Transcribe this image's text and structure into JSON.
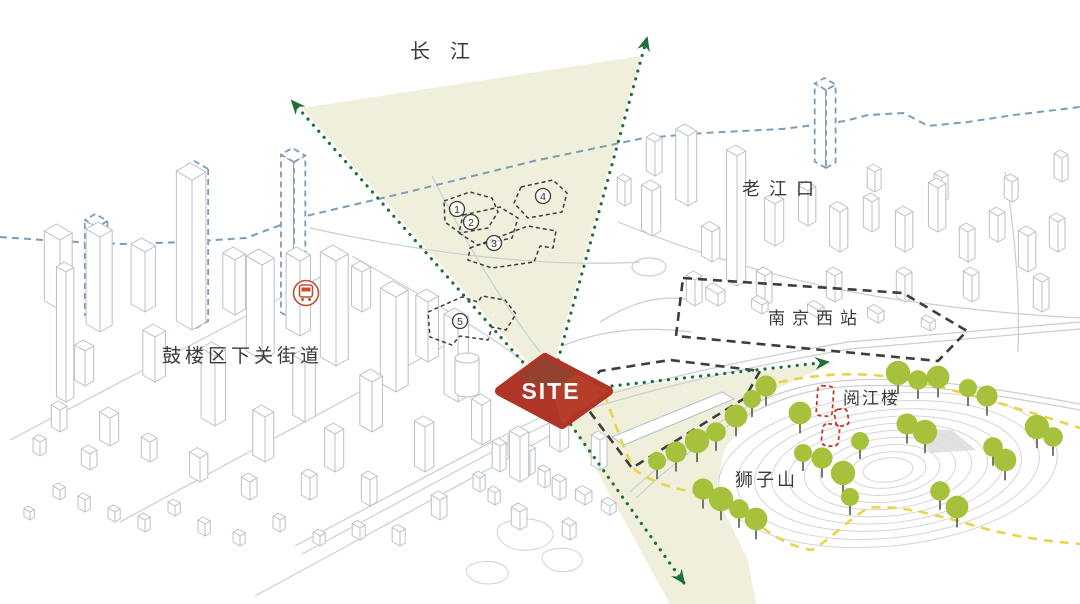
{
  "labels": {
    "yangtze": "长江",
    "laojiangkou": "老江口",
    "gulou_street": "鼓楼区下关街道",
    "nanjing_west_station": "南京西站",
    "yuejiang_tower": "阅江楼",
    "lion_mountain": "狮子山",
    "site": "SITE"
  },
  "colors": {
    "site_fill": "#ae3527",
    "site_facet_dark": "#8c4632",
    "site_facet_light": "#c24a2c",
    "view_cone": "#f0efdc",
    "arrow_green": "#1e6f39",
    "tree_green": "#a6c13c",
    "tree_stem": "#55594a",
    "yellow_boundary": "#e5d54b",
    "blue_dashed": "#7d9db6",
    "dark_dashed": "#3d3d3d",
    "red_dashed": "#c0392b",
    "building_line": "#b9c0c8",
    "contour_line": "#d5d5d5",
    "label_color": "#3a3a3a",
    "metro_icon": "#bf5030"
  },
  "markers": {
    "numbered": [
      {
        "label": "1",
        "x": 457,
        "y": 209
      },
      {
        "label": "2",
        "x": 471,
        "y": 222
      },
      {
        "label": "3",
        "x": 494,
        "y": 243
      },
      {
        "label": "4",
        "x": 543,
        "y": 196
      },
      {
        "label": "5",
        "x": 460,
        "y": 321
      }
    ]
  },
  "scene": {
    "cones": [
      "548,385 302,108 641,56",
      "556,396 836,362 766,394 724,450 716,495 748,560 756,604 670,604"
    ],
    "blue_skyline": "0,237 58,241 122,244 186,242 246,238 302,217 412,191 534,161 644,138 704,133 782,129 806,126 845,121 868,115 904,113 928,126 968,122 1014,115 1080,107",
    "blue_towers": [
      [
        97,
        322,
        14,
        12,
        95
      ],
      [
        196,
        328,
        16,
        14,
        152
      ],
      [
        294,
        320,
        15,
        13,
        158
      ],
      [
        826,
        168,
        13,
        11,
        78
      ]
    ],
    "buildings": [
      [
        60,
        310,
        18,
        14,
        70
      ],
      [
        100,
        332,
        16,
        14,
        95
      ],
      [
        145,
        312,
        16,
        12,
        60
      ],
      [
        192,
        330,
        18,
        16,
        150
      ],
      [
        235,
        315,
        14,
        12,
        55
      ],
      [
        262,
        360,
        18,
        14,
        95
      ],
      [
        300,
        336,
        16,
        12,
        75
      ],
      [
        336,
        366,
        18,
        14,
        105
      ],
      [
        362,
        312,
        12,
        10,
        40
      ],
      [
        396,
        392,
        18,
        14,
        95
      ],
      [
        428,
        362,
        14,
        12,
        60
      ],
      [
        458,
        402,
        16,
        12,
        80
      ],
      [
        372,
        432,
        14,
        12,
        50
      ],
      [
        305,
        422,
        14,
        12,
        60
      ],
      [
        155,
        382,
        14,
        12,
        45
      ],
      [
        85,
        386,
        12,
        10,
        35
      ],
      [
        215,
        426,
        16,
        12,
        70
      ],
      [
        66,
        402,
        11,
        9,
        130
      ],
      [
        110,
        446,
        12,
        10,
        28
      ],
      [
        265,
        462,
        14,
        10,
        45
      ],
      [
        335,
        472,
        12,
        10,
        38
      ],
      [
        425,
        472,
        12,
        10,
        45
      ],
      [
        482,
        445,
        12,
        10,
        40
      ],
      [
        60,
        432,
        10,
        8,
        22
      ],
      [
        150,
        462,
        10,
        8,
        20
      ],
      [
        200,
        482,
        12,
        9,
        24
      ],
      [
        250,
        500,
        10,
        8,
        18
      ],
      [
        90,
        470,
        10,
        8,
        16
      ],
      [
        40,
        456,
        8,
        7,
        14
      ],
      [
        310,
        500,
        10,
        8,
        22
      ],
      [
        370,
        506,
        10,
        8,
        26
      ],
      [
        440,
        520,
        10,
        8,
        20
      ],
      [
        520,
        482,
        12,
        10,
        45
      ],
      [
        560,
        452,
        12,
        10,
        55
      ],
      [
        600,
        470,
        10,
        8,
        30
      ],
      [
        520,
        530,
        10,
        8,
        18
      ],
      [
        570,
        540,
        9,
        7,
        14
      ],
      [
        60,
        500,
        8,
        6,
        10
      ],
      [
        85,
        512,
        8,
        6,
        12
      ],
      [
        115,
        522,
        8,
        6,
        10
      ],
      [
        145,
        532,
        8,
        6,
        12
      ],
      [
        175,
        516,
        8,
        6,
        10
      ],
      [
        205,
        536,
        8,
        6,
        12
      ],
      [
        240,
        546,
        8,
        6,
        10
      ],
      [
        280,
        532,
        8,
        6,
        12
      ],
      [
        320,
        546,
        8,
        6,
        10
      ],
      [
        30,
        520,
        7,
        5,
        8
      ],
      [
        360,
        540,
        9,
        6,
        12
      ],
      [
        400,
        546,
        9,
        6,
        14
      ],
      [
        500,
        472,
        9,
        7,
        26
      ],
      [
        515,
        460,
        8,
        6,
        20
      ],
      [
        530,
        475,
        8,
        6,
        24
      ],
      [
        545,
        488,
        8,
        6,
        16
      ],
      [
        560,
        500,
        9,
        7,
        18
      ],
      [
        585,
        505,
        11,
        8,
        10
      ],
      [
        610,
        515,
        10,
        7,
        9
      ],
      [
        480,
        492,
        8,
        6,
        14
      ],
      [
        495,
        505,
        8,
        6,
        12
      ],
      [
        652,
        236,
        12,
        10,
        45
      ],
      [
        688,
        206,
        14,
        10,
        70
      ],
      [
        712,
        262,
        12,
        9,
        30
      ],
      [
        737,
        286,
        12,
        10,
        130
      ],
      [
        775,
        246,
        12,
        10,
        42
      ],
      [
        808,
        226,
        11,
        9,
        35
      ],
      [
        840,
        252,
        12,
        9,
        40
      ],
      [
        872,
        232,
        10,
        8,
        30
      ],
      [
        905,
        252,
        11,
        9,
        36
      ],
      [
        938,
        232,
        11,
        9,
        44
      ],
      [
        968,
        262,
        10,
        8,
        30
      ],
      [
        998,
        242,
        10,
        8,
        26
      ],
      [
        1028,
        272,
        11,
        9,
        36
      ],
      [
        1058,
        252,
        10,
        8,
        30
      ],
      [
        695,
        306,
        10,
        8,
        26
      ],
      [
        765,
        306,
        10,
        8,
        30
      ],
      [
        835,
        302,
        10,
        8,
        26
      ],
      [
        905,
        302,
        10,
        8,
        26
      ],
      [
        972,
        302,
        10,
        8,
        26
      ],
      [
        1042,
        312,
        10,
        8,
        30
      ],
      [
        655,
        176,
        10,
        8,
        34
      ],
      [
        625,
        206,
        9,
        7,
        24
      ],
      [
        875,
        192,
        9,
        7,
        20
      ],
      [
        942,
        202,
        9,
        7,
        24
      ],
      [
        1012,
        202,
        9,
        7,
        20
      ],
      [
        1062,
        182,
        9,
        7,
        24
      ],
      [
        718,
        306,
        14,
        8,
        12
      ],
      [
        762,
        314,
        12,
        7,
        9
      ],
      [
        818,
        318,
        12,
        7,
        8
      ],
      [
        878,
        323,
        12,
        7,
        9
      ],
      [
        930,
        331,
        10,
        6,
        8
      ]
    ],
    "contours": {
      "cx": 888,
      "cy": 470,
      "rot": -6,
      "rings": [
        [
          170,
          76
        ],
        [
          152,
          68
        ],
        [
          134,
          60
        ],
        [
          117,
          53
        ],
        [
          100,
          46
        ],
        [
          84,
          39
        ],
        [
          68,
          32
        ],
        [
          52,
          25
        ],
        [
          38,
          18
        ],
        [
          25,
          12
        ]
      ]
    },
    "trees": [
      [
        657,
        461
      ],
      [
        676,
        452
      ],
      [
        697,
        441
      ],
      [
        716,
        432
      ],
      [
        736,
        416
      ],
      [
        752,
        399
      ],
      [
        766,
        386
      ],
      [
        898,
        373
      ],
      [
        918,
        380
      ],
      [
        938,
        377
      ],
      [
        968,
        388
      ],
      [
        987,
        396
      ],
      [
        1037,
        427
      ],
      [
        1053,
        437
      ],
      [
        800,
        413
      ],
      [
        860,
        441
      ],
      [
        907,
        424
      ],
      [
        925,
        432
      ],
      [
        993,
        447
      ],
      [
        1005,
        460
      ],
      [
        803,
        453
      ],
      [
        822,
        458
      ],
      [
        843,
        473
      ],
      [
        940,
        491
      ],
      [
        957,
        507
      ],
      [
        850,
        497
      ],
      [
        703,
        489
      ],
      [
        721,
        499
      ],
      [
        739,
        509
      ],
      [
        756,
        519
      ]
    ],
    "arrows": [
      [
        528,
        368,
        292,
        101
      ],
      [
        558,
        360,
        647,
        38
      ],
      [
        612,
        386,
        828,
        362
      ],
      [
        566,
        418,
        684,
        583
      ]
    ]
  }
}
